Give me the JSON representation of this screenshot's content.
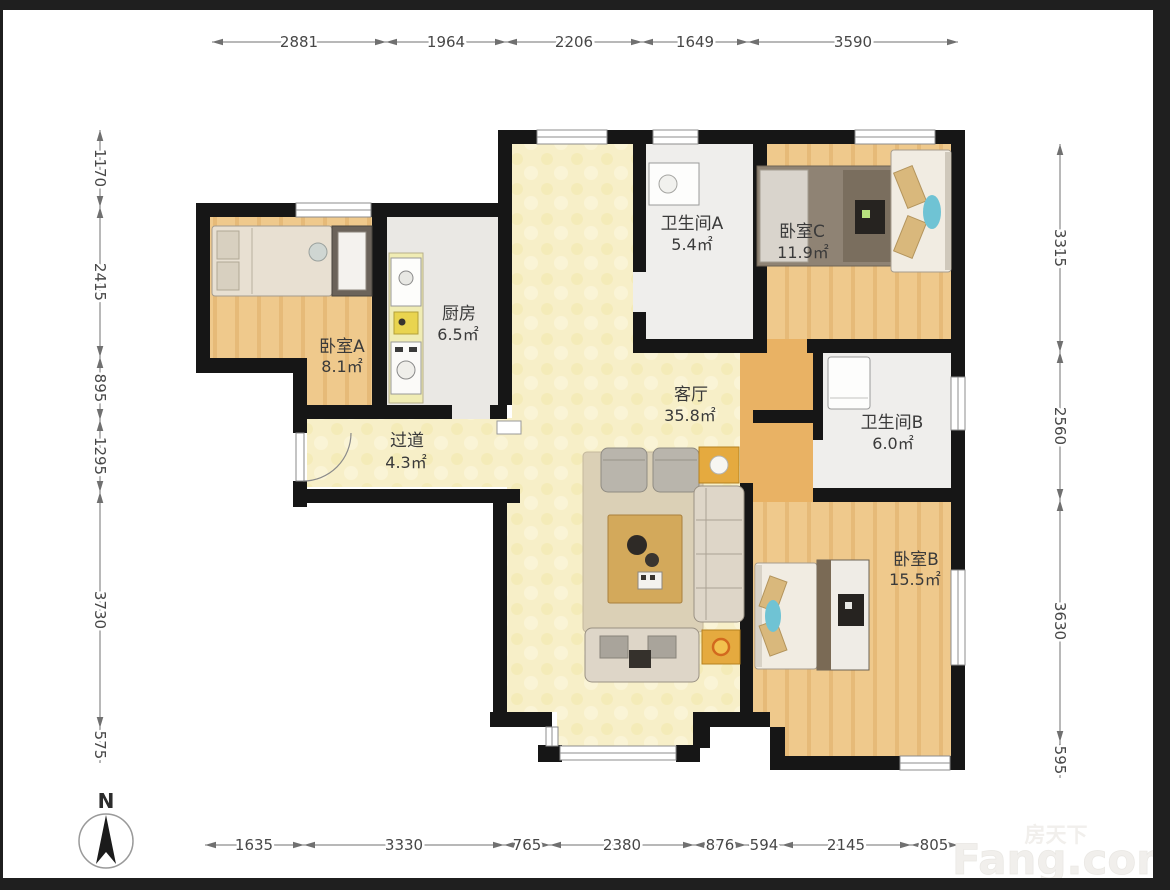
{
  "plan": {
    "rooms": {
      "bedroom_a": {
        "name": "卧室A",
        "area": "8.1㎡"
      },
      "kitchen": {
        "name": "厨房",
        "area": "6.5㎡"
      },
      "hallway": {
        "name": "过道",
        "area": "4.3㎡"
      },
      "bath_a": {
        "name": "卫生间A",
        "area": "5.4㎡"
      },
      "bedroom_c": {
        "name": "卧室C",
        "area": "11.9㎡"
      },
      "living": {
        "name": "客厅",
        "area": "35.8㎡"
      },
      "bath_b": {
        "name": "卫生间B",
        "area": "6.0㎡"
      },
      "bedroom_b": {
        "name": "卧室B",
        "area": "15.5㎡"
      }
    },
    "dims": {
      "top": [
        "2881",
        "1964",
        "2206",
        "1649",
        "3590"
      ],
      "left": [
        "1170",
        "2415",
        "895",
        "1295",
        "3730",
        "575"
      ],
      "right": [
        "3315",
        "2560",
        "3630",
        "595"
      ],
      "bottom": [
        "1635",
        "3330",
        "765",
        "2380",
        "876",
        "594",
        "2145",
        "805"
      ]
    },
    "compass": {
      "label": "N"
    },
    "watermark": {
      "brand": "房天下",
      "site": "Fang.com"
    },
    "colors": {
      "wall": "#161616",
      "wood_floor": "#efc98c",
      "living_floor": "#f7efc8",
      "service_floor": "#edecea",
      "corridor_floor": "#e9b264",
      "accent_teal": "#6fc3d4",
      "accent_yellow": "#e5aa3f"
    }
  }
}
